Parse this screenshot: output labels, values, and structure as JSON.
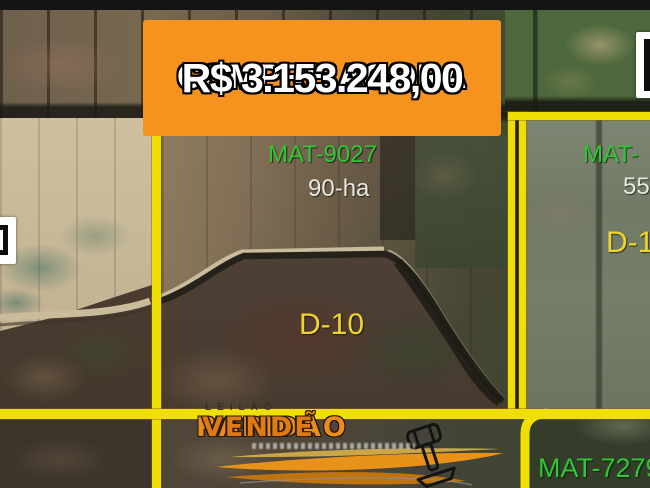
{
  "banner": {
    "headline": "COMPRE AGORA",
    "price": "R$ 3.153.248,00"
  },
  "parcels": {
    "main": {
      "mat": "MAT-9027",
      "area": "90-ha",
      "lot": "D-10"
    },
    "right": {
      "mat": "MAT-",
      "area": "55",
      "lot": "D-1"
    },
    "bottom_right": {
      "mat": "MAT-7279"
    }
  },
  "watermark": {
    "auction_label": "LEILÃO",
    "brand_word1": "RAPIDÃO",
    "brand_word2": "VENDE"
  },
  "colors": {
    "banner_bg": "#F6921E",
    "boundary_yellow": "#EFDF06",
    "mat_green": "#2FC832",
    "lot_yellow": "#EFD42B",
    "area_white": "#E9E7DE",
    "brand_orange": "#ED8C1E"
  }
}
